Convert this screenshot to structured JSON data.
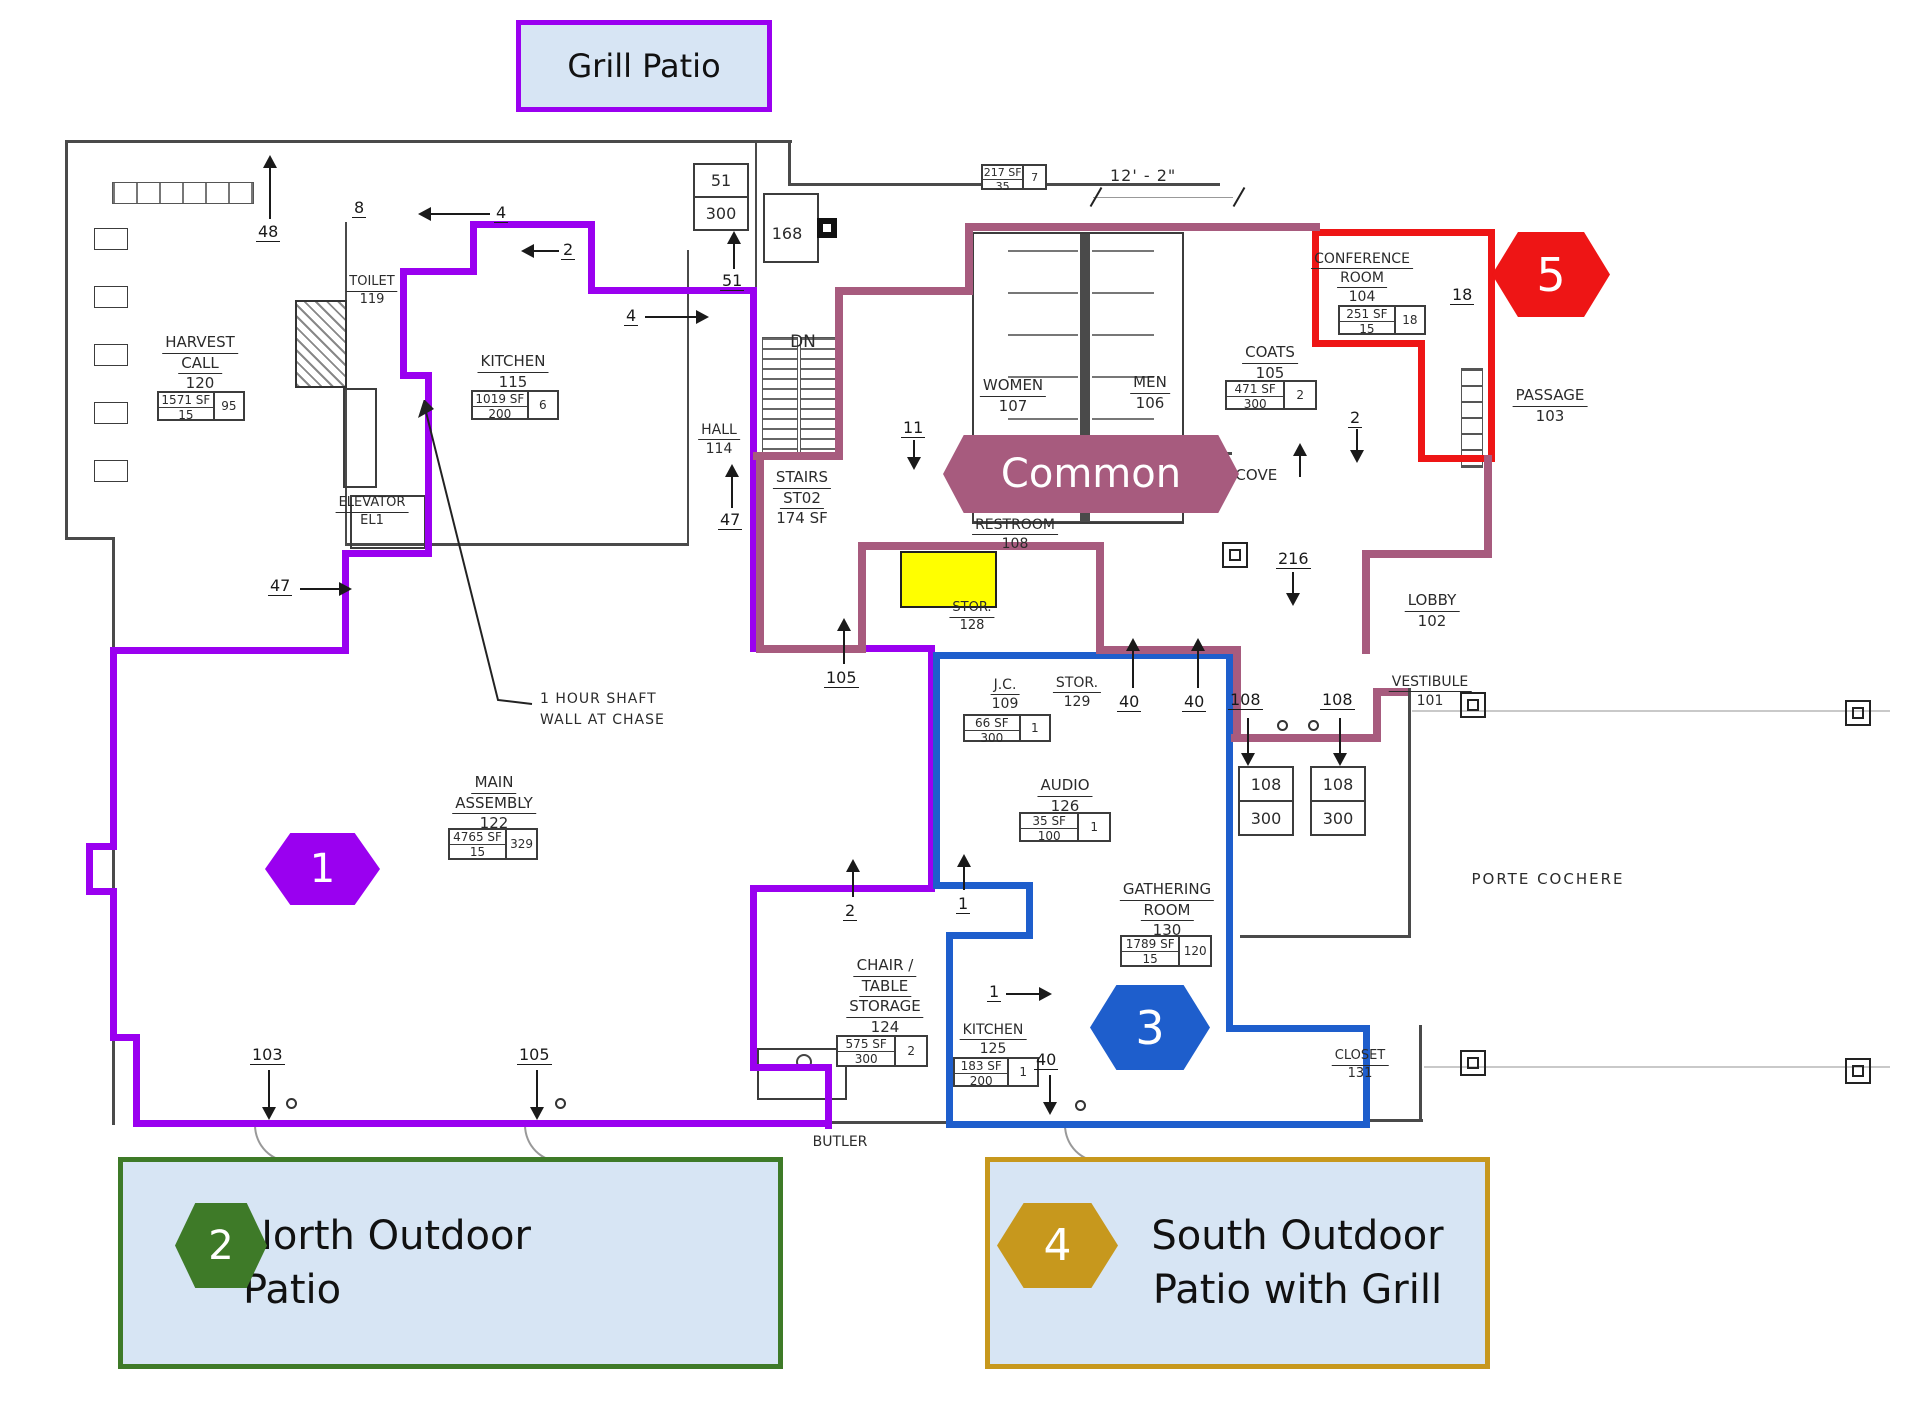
{
  "colors": {
    "purple": "#9a00f0",
    "mauve": "#a75b7e",
    "red": "#ee1515",
    "blue": "#1e5ecc",
    "green": "#3e7a28",
    "gold": "#c7981d",
    "panel_fill": "#d7e5f4",
    "highlight": "#ffff00"
  },
  "legend": {
    "grill_patio": {
      "label": "Grill Patio"
    },
    "north_patio": {
      "label": "North Outdoor Patio"
    },
    "south_patio": {
      "line1": "South Outdoor",
      "line2": "Patio with Grill"
    },
    "common_banner": {
      "label": "Common"
    }
  },
  "badges": {
    "b1": "1",
    "b2": "2",
    "b3": "3",
    "b4": "4",
    "b5": "5"
  },
  "plan": {
    "rooms": [
      {
        "cx": 200,
        "y": 333,
        "name": [
          "HARVEST",
          "CALL"
        ],
        "num": "120"
      },
      {
        "cx": 372,
        "y": 274,
        "name": [
          "TOILET"
        ],
        "num": "119",
        "fs": 13
      },
      {
        "cx": 513,
        "y": 352,
        "name": [
          "KITCHEN"
        ],
        "num": "115"
      },
      {
        "cx": 719,
        "y": 421,
        "name": [
          "HALL"
        ],
        "num": "114",
        "fs": 14
      },
      {
        "cx": 802,
        "y": 468,
        "name": [
          "STAIRS",
          "ST02"
        ],
        "extra": "174 SF",
        "fs": 15
      },
      {
        "cx": 1013,
        "y": 376,
        "name": [
          "WOMEN"
        ],
        "num": "107"
      },
      {
        "cx": 1150,
        "y": 373,
        "name": [
          "MEN"
        ],
        "num": "106"
      },
      {
        "cx": 1270,
        "y": 343,
        "name": [
          "COATS"
        ],
        "num": "105"
      },
      {
        "cx": 1362,
        "y": 250,
        "name": [
          "CONFERENCE",
          "ROOM"
        ],
        "num": "104",
        "fs": 14
      },
      {
        "cx": 1550,
        "y": 386,
        "name": [
          "PASSAGE"
        ],
        "num": "103"
      },
      {
        "cx": 1432,
        "y": 591,
        "name": [
          "LOBBY"
        ],
        "num": "102"
      },
      {
        "cx": 1430,
        "y": 673,
        "name": [
          "VESTIBULE"
        ],
        "num": "101",
        "fs": 14
      },
      {
        "cx": 1015,
        "y": 516,
        "name": [
          "RESTROOM"
        ],
        "num": "108",
        "fs": 14
      },
      {
        "cx": 972,
        "y": 600,
        "name": [
          "STOR."
        ],
        "num": "128",
        "fs": 13
      },
      {
        "cx": 1005,
        "y": 676,
        "name": [
          "J.C."
        ],
        "num": "109",
        "fs": 14
      },
      {
        "cx": 1077,
        "y": 674,
        "name": [
          "STOR."
        ],
        "num": "129",
        "fs": 14
      },
      {
        "cx": 1065,
        "y": 776,
        "name": [
          "AUDIO"
        ],
        "num": "126"
      },
      {
        "cx": 494,
        "y": 773,
        "name": [
          "MAIN",
          "ASSEMBLY"
        ],
        "num": "122"
      },
      {
        "cx": 885,
        "y": 956,
        "name": [
          "CHAIR /",
          "TABLE",
          "STORAGE"
        ],
        "num": "124"
      },
      {
        "cx": 993,
        "y": 1021,
        "name": [
          "KITCHEN"
        ],
        "num": "125",
        "fs": 14
      },
      {
        "cx": 1167,
        "y": 880,
        "name": [
          "GATHERING",
          "ROOM"
        ],
        "num": "130"
      },
      {
        "cx": 1360,
        "y": 1048,
        "name": [
          "CLOSET"
        ],
        "num": "131",
        "fs": 13
      },
      {
        "cx": 840,
        "y": 1133,
        "name": [
          "BUTLER"
        ],
        "noU": true,
        "fs": 14
      },
      {
        "cx": 1548,
        "y": 870,
        "name": [
          "PORTE COCHERE"
        ],
        "noU": true,
        "fs": 15,
        "ls": 2
      },
      {
        "cx": 372,
        "y": 495,
        "name": [
          "ELEVATOR"
        ],
        "num": "EL1",
        "fs": 13
      },
      {
        "cx": 803,
        "y": 331,
        "name": [
          "DN"
        ],
        "noU": true,
        "fs": 17
      },
      {
        "cx": 1247,
        "y": 466,
        "name": [
          "ALCOVE"
        ],
        "noU": true,
        "fs": 15
      },
      {
        "cx": 787,
        "y": 224,
        "name": [
          "168"
        ],
        "noU": true,
        "fs": 16
      }
    ],
    "stat_boxes": [
      {
        "x": 157,
        "y": 391,
        "w": 88,
        "h": 30,
        "sf": "1571 SF",
        "load": "15",
        "occ": "95"
      },
      {
        "x": 471,
        "y": 390,
        "w": 88,
        "h": 30,
        "sf": "1019 SF",
        "load": "200",
        "occ": "6"
      },
      {
        "x": 1225,
        "y": 380,
        "w": 92,
        "h": 30,
        "sf": "471 SF",
        "load": "300",
        "occ": "2"
      },
      {
        "x": 1338,
        "y": 305,
        "w": 88,
        "h": 30,
        "sf": "251 SF",
        "load": "15",
        "occ": "18"
      },
      {
        "x": 963,
        "y": 714,
        "w": 88,
        "h": 28,
        "sf": "66 SF",
        "load": "300",
        "occ": "1"
      },
      {
        "x": 1019,
        "y": 812,
        "w": 92,
        "h": 30,
        "sf": "35 SF",
        "load": "100",
        "occ": "1"
      },
      {
        "x": 448,
        "y": 828,
        "w": 90,
        "h": 32,
        "sf": "4765 SF",
        "load": "15",
        "occ": "329"
      },
      {
        "x": 836,
        "y": 1035,
        "w": 92,
        "h": 32,
        "sf": "575 SF",
        "load": "300",
        "occ": "2"
      },
      {
        "x": 953,
        "y": 1057,
        "w": 86,
        "h": 30,
        "sf": "183 SF",
        "load": "200",
        "occ": "1"
      },
      {
        "x": 1120,
        "y": 935,
        "w": 92,
        "h": 32,
        "sf": "1789 SF",
        "load": "15",
        "occ": "120"
      },
      {
        "x": 981,
        "y": 164,
        "w": 66,
        "h": 26,
        "sf": "217 SF",
        "load": "35",
        "occ": "7",
        "fs": 11
      }
    ],
    "stack_boxes": [
      {
        "x": 693,
        "y": 163,
        "w": 56,
        "h": 68,
        "top": "51",
        "bottom": "300"
      },
      {
        "x": 1238,
        "y": 766,
        "w": 56,
        "h": 70,
        "top": "108",
        "bottom": "300"
      },
      {
        "x": 1310,
        "y": 766,
        "w": 56,
        "h": 70,
        "top": "108",
        "bottom": "300"
      }
    ],
    "dimension": {
      "label": "12' - 2\""
    },
    "notes": {
      "shaft_line1": "1 HOUR SHAFT",
      "shaft_line2": "WALL AT CHASE"
    },
    "annotations": [
      {
        "t": "48",
        "x": 256,
        "y": 222,
        "d": "up",
        "lx": 269,
        "ly": 167,
        "ll": 52
      },
      {
        "t": "8",
        "x": 352,
        "y": 198
      },
      {
        "t": "4",
        "x": 494,
        "y": 203,
        "d": "left",
        "lx": 430,
        "ly": 213,
        "ll": 60
      },
      {
        "t": "2",
        "x": 561,
        "y": 240,
        "d": "left",
        "lx": 533,
        "ly": 250,
        "ll": 26
      },
      {
        "t": "4",
        "x": 624,
        "y": 306,
        "d": "right",
        "lx": 645,
        "ly": 316,
        "ll": 52
      },
      {
        "t": "51",
        "x": 720,
        "y": 271,
        "d": "up",
        "lx": 733,
        "ly": 243,
        "ll": 26
      },
      {
        "t": "47",
        "x": 718,
        "y": 510,
        "d": "up",
        "lx": 731,
        "ly": 476,
        "ll": 32
      },
      {
        "t": "47",
        "x": 268,
        "y": 576,
        "d": "right",
        "lx": 300,
        "ly": 588,
        "ll": 40
      },
      {
        "t": "11",
        "x": 901,
        "y": 418,
        "d": "down",
        "lx": 913,
        "ly": 440,
        "ll": 18
      },
      {
        "t": "105",
        "x": 824,
        "y": 668,
        "d": "up",
        "lx": 843,
        "ly": 630,
        "ll": 34
      },
      {
        "t": "2",
        "x": 1348,
        "y": 408,
        "d": "down",
        "lx": 1356,
        "ly": 429,
        "ll": 22
      },
      {
        "t": "216",
        "x": 1276,
        "y": 549,
        "d": "down",
        "lx": 1292,
        "ly": 572,
        "ll": 22
      },
      {
        "t": "40",
        "x": 1117,
        "y": 692,
        "d": "up",
        "lx": 1132,
        "ly": 650,
        "ll": 38
      },
      {
        "t": "40",
        "x": 1182,
        "y": 692,
        "d": "up",
        "lx": 1197,
        "ly": 650,
        "ll": 38
      },
      {
        "t": "108",
        "x": 1228,
        "y": 690,
        "d": "down",
        "lx": 1247,
        "ly": 718,
        "ll": 36
      },
      {
        "t": "108",
        "x": 1320,
        "y": 690,
        "d": "down",
        "lx": 1339,
        "ly": 718,
        "ll": 36
      },
      {
        "t": "18",
        "x": 1450,
        "y": 285
      },
      {
        "t": "2",
        "x": 843,
        "y": 901,
        "d": "up",
        "lx": 852,
        "ly": 871,
        "ll": 26
      },
      {
        "t": "1",
        "x": 956,
        "y": 894,
        "d": "up",
        "lx": 963,
        "ly": 866,
        "ll": 24
      },
      {
        "t": "1",
        "x": 987,
        "y": 982,
        "d": "right",
        "lx": 1006,
        "ly": 993,
        "ll": 34
      },
      {
        "t": "40",
        "x": 1034,
        "y": 1050,
        "d": "down",
        "lx": 1049,
        "ly": 1075,
        "ll": 28
      },
      {
        "t": "103",
        "x": 250,
        "y": 1045,
        "d": "down",
        "lx": 268,
        "ly": 1070,
        "ll": 38
      },
      {
        "t": "105",
        "x": 517,
        "y": 1045,
        "d": "down",
        "lx": 536,
        "ly": 1070,
        "ll": 38
      },
      {
        "t": "",
        "x": 0,
        "y": 0,
        "d": "up",
        "lx": 1299,
        "ly": 455,
        "ll": 22
      }
    ]
  }
}
